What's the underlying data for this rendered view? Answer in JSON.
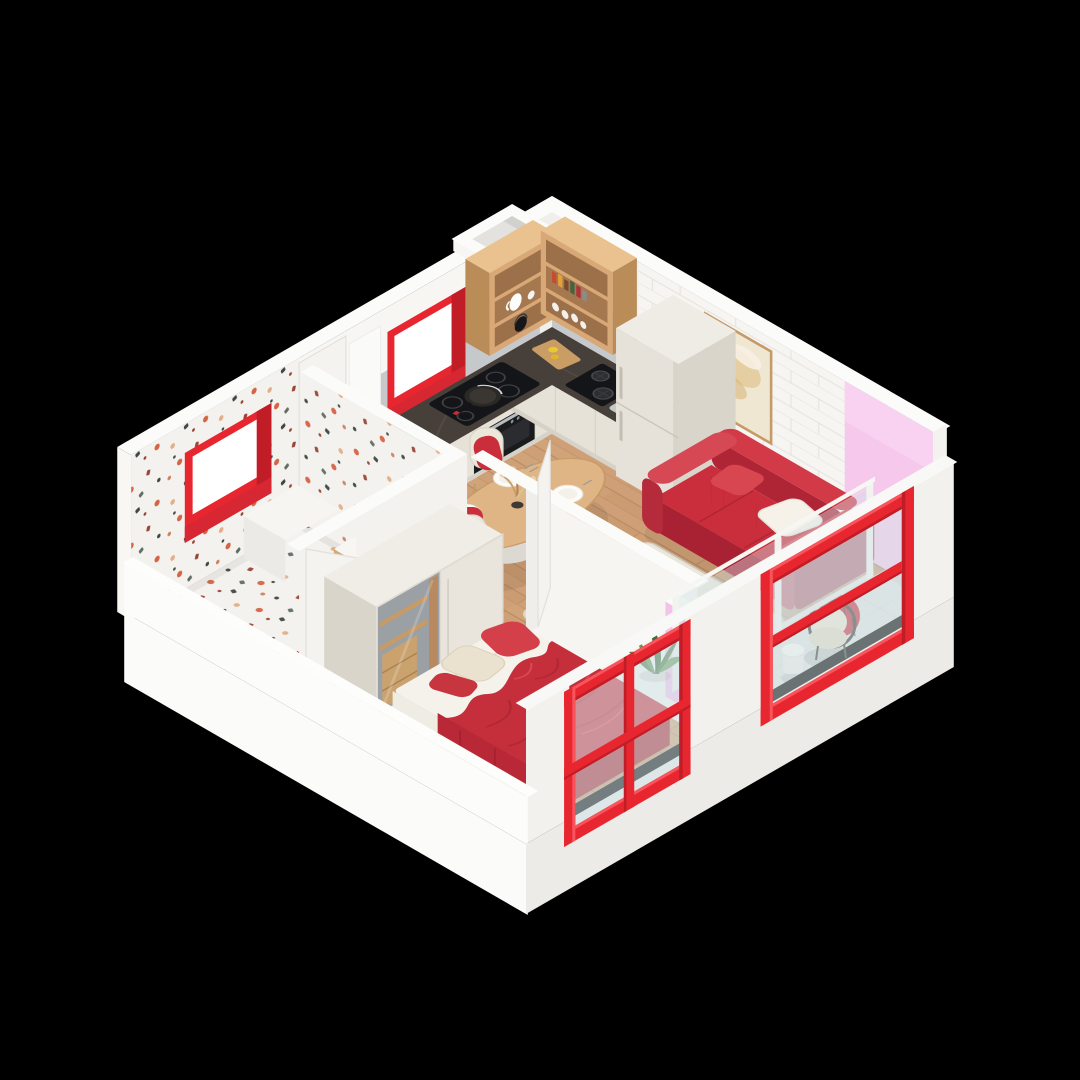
{
  "canvas": {
    "width": 1080,
    "height": 1080,
    "background": "#000000"
  },
  "scene": {
    "type": "isometric-cutaway-floor-plan",
    "style": "3d-architectural-render",
    "accent_color": "#e8262f",
    "rooms": {
      "kitchen": {
        "label": "Kitchen",
        "items": [
          "l-shaped-counter",
          "induction-hob",
          "frying-pan",
          "gas-hob",
          "sink",
          "oven",
          "fridge",
          "wood-open-shelves",
          "red-framed-window",
          "vent-shaft",
          "cutting-board-with-lemons"
        ]
      },
      "dining": {
        "label": "Dining area",
        "items": [
          "oval-wood-table",
          "red-cream-chairs",
          "table-settings",
          "vase-with-dried-sprigs"
        ]
      },
      "living": {
        "label": "Living room",
        "items": [
          "red-sofa",
          "white-throw-pillow",
          "round-coffee-table",
          "cream-rug",
          "framed-wall-art",
          "green-plant",
          "textured-brick-wall"
        ]
      },
      "bedroom": {
        "label": "Bedroom",
        "items": [
          "double-bed",
          "red-duvet",
          "red-and-beige-pillows",
          "sliding-door-wardrobe",
          "large-red-window"
        ]
      },
      "bathroom": {
        "label": "Bathroom",
        "items": [
          "terrazzo-walls",
          "terrazzo-floor",
          "wood-vanity",
          "white-basin",
          "striped-red-mat",
          "red-framed-window",
          "white-bench"
        ]
      },
      "balcony": {
        "label": "Balcony",
        "items": [
          "red-frame-window",
          "glass-balustrade",
          "wicker-armchair",
          "round-side-table",
          "pink-accent-wall",
          "tiled-floor"
        ]
      },
      "hallway": {
        "label": "Hallway",
        "items": [
          "entrance-door",
          "bedroom-door",
          "bathroom-door"
        ]
      }
    }
  },
  "palette": {
    "bg": "#000000",
    "red": "#e8262f",
    "redBright": "#f8545c",
    "redDeep": "#c01d27",
    "redReveal": "#d62732",
    "sofa": "#ca2e3c",
    "sofaDark": "#a82233",
    "sofaTop": "#d23a47",
    "blanket": "#c52f3c",
    "pink": "#f3c3ea",
    "pinkWall": "#f6c9ec",
    "woodShelf": "#d9a877",
    "woodDark": "#b98c58",
    "woodTable": "#e0b586",
    "floorWood": "#cfa077",
    "floorLine": "#b2855c",
    "terrBase": "#f3f2ef",
    "wallL": "#f7f6f3",
    "wallR": "#f0efec",
    "wallTop": "#fbfbf9",
    "partL": "#f3f2ef",
    "partR": "#f6f5f2",
    "slabL": "#fbfbf9",
    "slabR": "#ecebe8",
    "counterTop": "#463f3a",
    "cabinet": "#e7e2d8",
    "fridge": "#e6e2d9",
    "splash": "#c6c9cb",
    "rug": "#eae6db",
    "glass": "#d4e4e8",
    "appliance": "#141518",
    "leaf": "#4e7d49",
    "leafLight": "#6da15f",
    "tileBalcony": "#e3e4e1",
    "cream": "#ece7db",
    "doorWhite": "#f4f3f0"
  }
}
